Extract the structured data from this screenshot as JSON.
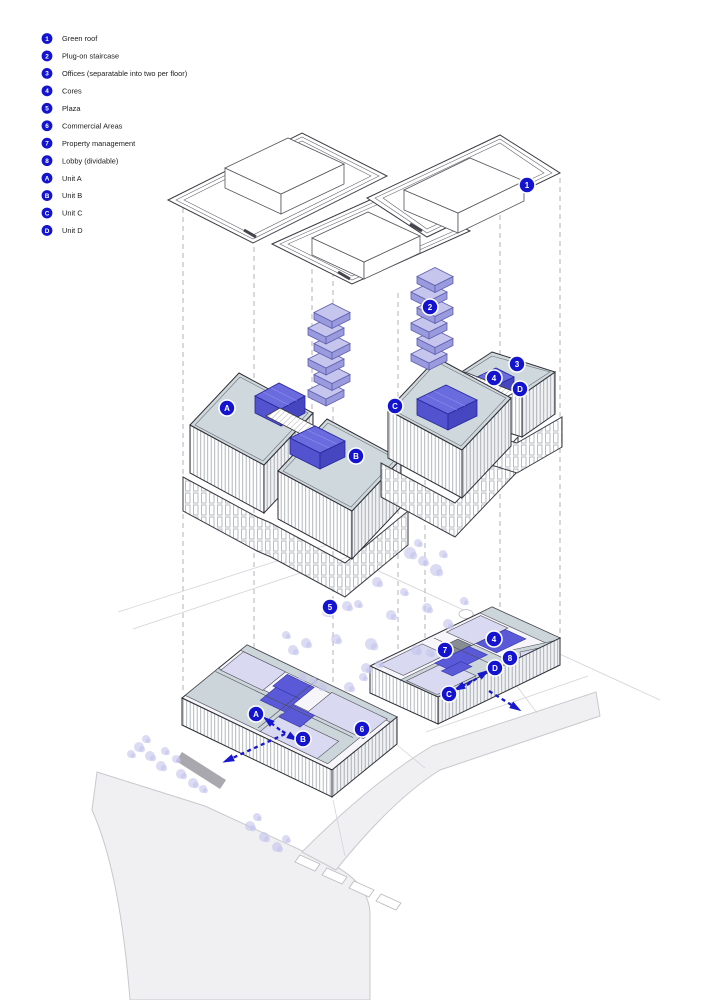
{
  "colors": {
    "badge_blue": "#1414cf",
    "core_blue": "#5a5ad8",
    "lavender": "#c5c5ee",
    "deck_gray": "#cfd8dd",
    "road_gray": "#f0f0f3",
    "arrow_blue": "#1717cf"
  },
  "legend": {
    "items": [
      {
        "id": "1",
        "label": "Green roof"
      },
      {
        "id": "2",
        "label": "Plug-on staircase"
      },
      {
        "id": "3",
        "label": "Offices (separatable into two per floor)"
      },
      {
        "id": "4",
        "label": "Cores"
      },
      {
        "id": "5",
        "label": "Plaza"
      },
      {
        "id": "6",
        "label": "Commercial Areas"
      },
      {
        "id": "7",
        "label": "Property management"
      },
      {
        "id": "8",
        "label": "Lobby (dividable)"
      },
      {
        "id": "A",
        "label": "Unit A"
      },
      {
        "id": "B",
        "label": "Unit B"
      },
      {
        "id": "C",
        "label": "Unit C"
      },
      {
        "id": "D",
        "label": "Unit D"
      }
    ]
  },
  "diagram": {
    "badges": [
      {
        "label": "1",
        "x": 527,
        "y": 185,
        "layer": "roof"
      },
      {
        "label": "2",
        "x": 430,
        "y": 307,
        "layer": "staircase"
      },
      {
        "label": "A",
        "x": 227,
        "y": 408,
        "layer": "offices"
      },
      {
        "label": "B",
        "x": 356,
        "y": 456,
        "layer": "offices"
      },
      {
        "label": "C",
        "x": 395,
        "y": 406,
        "layer": "offices"
      },
      {
        "label": "3",
        "x": 517,
        "y": 364,
        "layer": "offices"
      },
      {
        "label": "4",
        "x": 494,
        "y": 378,
        "layer": "offices"
      },
      {
        "label": "D",
        "x": 520,
        "y": 389,
        "layer": "offices"
      },
      {
        "label": "5",
        "x": 330,
        "y": 607,
        "layer": "ground"
      },
      {
        "label": "7",
        "x": 445,
        "y": 650,
        "layer": "ground"
      },
      {
        "label": "4",
        "x": 494,
        "y": 639,
        "layer": "ground"
      },
      {
        "label": "8",
        "x": 510,
        "y": 658,
        "layer": "ground"
      },
      {
        "label": "D",
        "x": 495,
        "y": 668,
        "layer": "ground"
      },
      {
        "label": "C",
        "x": 449,
        "y": 694,
        "layer": "ground"
      },
      {
        "label": "A",
        "x": 256,
        "y": 714,
        "layer": "ground"
      },
      {
        "label": "B",
        "x": 303,
        "y": 739,
        "layer": "ground"
      },
      {
        "label": "6",
        "x": 362,
        "y": 729,
        "layer": "ground"
      }
    ],
    "arrows": [
      {
        "name": "to-unit-a",
        "pts": [
          [
            280,
            730
          ],
          [
            266,
            719
          ]
        ]
      },
      {
        "name": "to-unit-b",
        "pts": [
          [
            282,
            731
          ],
          [
            295,
            739
          ]
        ]
      },
      {
        "name": "exit-west",
        "pts": [
          [
            285,
            734
          ],
          [
            226,
            761
          ]
        ]
      },
      {
        "name": "to-unit-c",
        "pts": [
          [
            472,
            681
          ],
          [
            457,
            689
          ]
        ]
      },
      {
        "name": "to-unit-d",
        "pts": [
          [
            467,
            685
          ],
          [
            486,
            672
          ]
        ]
      },
      {
        "name": "exit-east",
        "pts": [
          [
            489,
            691
          ],
          [
            518,
            709
          ]
        ]
      }
    ],
    "projection_lines": [
      {
        "x": 183,
        "y1": 208,
        "y2": 694
      },
      {
        "x": 254,
        "y1": 247,
        "y2": 702
      },
      {
        "x": 312,
        "y1": 260,
        "y2": 452
      },
      {
        "x": 333,
        "y1": 272,
        "y2": 686
      },
      {
        "x": 398,
        "y1": 293,
        "y2": 662
      },
      {
        "x": 425,
        "y1": 300,
        "y2": 650
      },
      {
        "x": 500,
        "y1": 215,
        "y2": 655
      },
      {
        "x": 560,
        "y1": 178,
        "y2": 640
      }
    ],
    "staircase_towers": [
      {
        "cx": 326,
        "base_y": 390
      },
      {
        "cx": 429,
        "base_y": 354
      }
    ],
    "trees": [
      [
        410,
        553,
        6
      ],
      [
        423,
        561,
        5
      ],
      [
        436,
        570,
        6
      ],
      [
        443,
        554,
        4
      ],
      [
        418,
        543,
        4
      ],
      [
        377,
        582,
        5
      ],
      [
        391,
        615,
        5
      ],
      [
        404,
        592,
        4
      ],
      [
        427,
        608,
        5
      ],
      [
        448,
        624,
        5
      ],
      [
        464,
        601,
        4
      ],
      [
        416,
        650,
        5
      ],
      [
        430,
        653,
        4
      ],
      [
        293,
        650,
        5
      ],
      [
        306,
        643,
        5
      ],
      [
        327,
        612,
        5
      ],
      [
        347,
        606,
        5
      ],
      [
        358,
        604,
        4
      ],
      [
        366,
        668,
        5
      ],
      [
        379,
        664,
        4
      ],
      [
        313,
        681,
        4
      ],
      [
        302,
        677,
        4
      ],
      [
        322,
        687,
        4
      ],
      [
        349,
        687,
        5
      ],
      [
        363,
        677,
        4
      ],
      [
        286,
        635,
        4
      ],
      [
        336,
        639,
        5
      ],
      [
        371,
        644,
        6
      ],
      [
        139,
        747,
        5
      ],
      [
        150,
        756,
        5
      ],
      [
        161,
        766,
        5
      ],
      [
        181,
        774,
        5
      ],
      [
        193,
        783,
        5
      ],
      [
        165,
        751,
        4
      ],
      [
        146,
        739,
        4
      ],
      [
        176,
        759,
        4
      ],
      [
        131,
        754,
        4
      ],
      [
        203,
        789,
        4
      ],
      [
        250,
        826,
        5
      ],
      [
        264,
        837,
        5
      ],
      [
        277,
        847,
        5
      ],
      [
        286,
        839,
        4
      ],
      [
        257,
        817,
        4
      ]
    ],
    "parking_strips": [
      [
        300,
        855
      ],
      [
        327,
        868
      ],
      [
        354,
        881
      ],
      [
        381,
        894
      ]
    ]
  }
}
